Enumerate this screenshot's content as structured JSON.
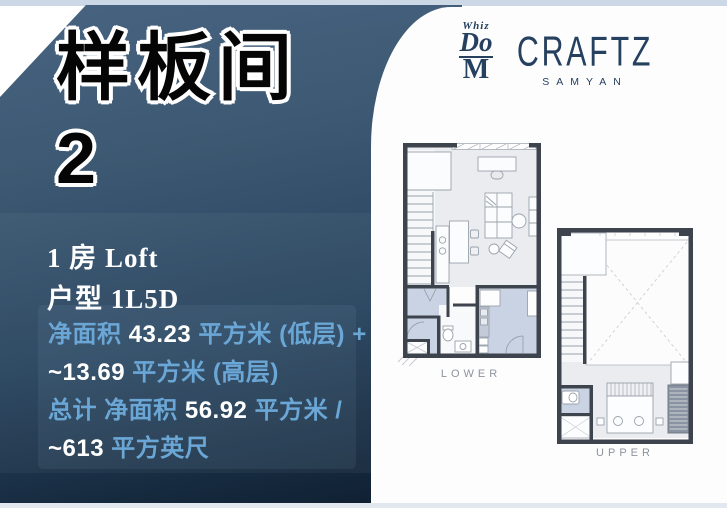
{
  "left_panel": {
    "title": "样板间",
    "unit_number": "2",
    "room_type": "1 房 Loft",
    "layout_code": "户型 1L5D",
    "area": {
      "line1": {
        "label": "净面积 ",
        "value": "43.23",
        "unit": " 平方米 (低层) +"
      },
      "line2": {
        "value": "~13.69",
        "unit": " 平方米 (高层)"
      },
      "line3": {
        "label": "总计 净面积 ",
        "value": "56.92",
        "unit": " 平方米 /"
      },
      "line4": {
        "value": "~613",
        "unit": " 平方英尺"
      }
    }
  },
  "logo": {
    "whiz": "Whiz",
    "do": "Do",
    "m": "M",
    "brand": "CRAFTZ",
    "sub_brand": "SAMYAN"
  },
  "floor_plans": {
    "lower_label": "LOWER",
    "upper_label": "UPPER"
  },
  "colors": {
    "panel_top": "#46627f",
    "panel_bottom": "#0d1d2e",
    "accent_text_blue": "#6ba7d6",
    "logo_navy": "#26405f",
    "wall_dark": "#3e444d",
    "room_blue": "#cad3e4",
    "floor_gray": "#eaecf0",
    "label_gray": "#8d949d",
    "topbar": "#ccd8e5"
  }
}
